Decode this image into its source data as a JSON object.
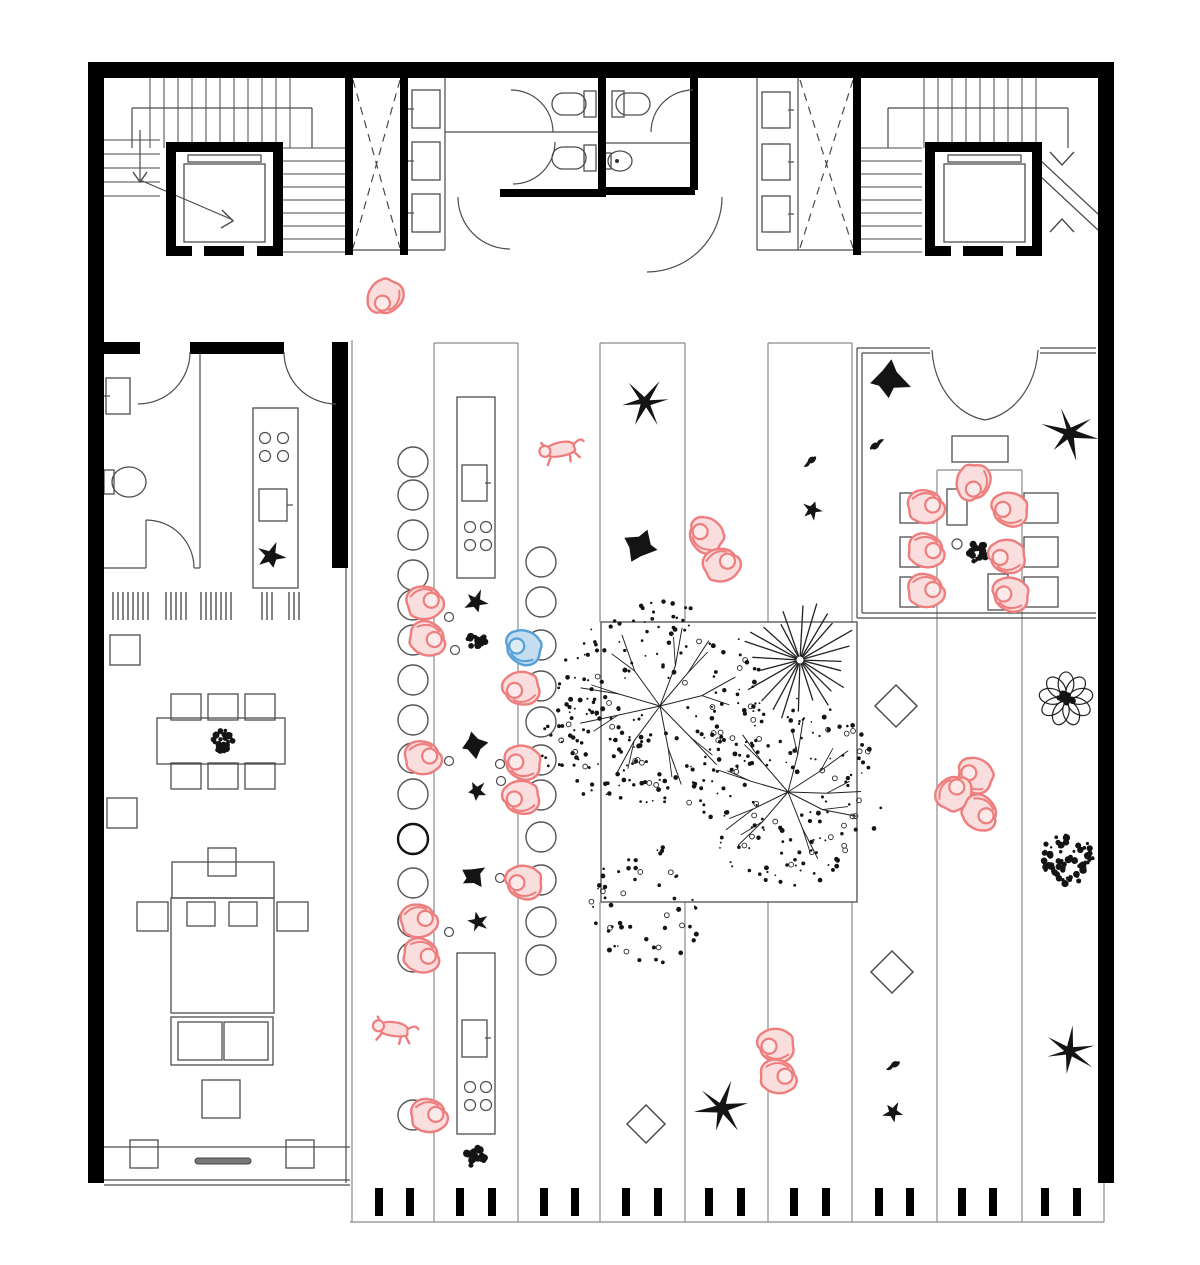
{
  "meta": {
    "width": 1200,
    "height": 1265
  },
  "colors": {
    "wall": "#000000",
    "thin": "#4a4a4a",
    "strip": "#8a8a8a",
    "plant": "#141414",
    "pink": "#ee7d7d",
    "pinkFill": "#fadddd",
    "pinkHead": "#fceaea",
    "blue": "#55a0d6",
    "blueFill": "#c4def0",
    "blueHead": "#ddebf6"
  },
  "wallRects": [
    [
      88,
      62,
      1026,
      16
    ],
    [
      88,
      62,
      16,
      1121
    ],
    [
      1098,
      62,
      16,
      1121
    ],
    [
      345,
      78,
      8,
      177
    ],
    [
      400,
      78,
      8,
      177
    ],
    [
      853,
      78,
      8,
      177
    ],
    [
      598,
      78,
      8,
      119
    ],
    [
      690,
      78,
      8,
      112
    ],
    [
      500,
      189,
      98,
      8
    ],
    [
      603,
      187,
      92,
      8
    ],
    [
      104,
      342,
      36,
      12
    ],
    [
      190,
      342,
      94,
      12
    ],
    [
      332,
      342,
      16,
      226
    ],
    [
      166,
      142,
      117,
      10
    ],
    [
      166,
      142,
      10,
      114
    ],
    [
      273,
      142,
      10,
      114
    ],
    [
      166,
      246,
      26,
      10
    ],
    [
      204,
      246,
      40,
      10
    ],
    [
      257,
      246,
      26,
      10
    ],
    [
      925,
      142,
      117,
      10
    ],
    [
      925,
      142,
      10,
      114
    ],
    [
      1032,
      142,
      10,
      114
    ],
    [
      925,
      246,
      26,
      10
    ],
    [
      963,
      246,
      40,
      10
    ],
    [
      1016,
      246,
      26,
      10
    ]
  ],
  "frames": [
    [
      184,
      164,
      81,
      78
    ],
    [
      188,
      155,
      73,
      7
    ],
    [
      944,
      164,
      81,
      78
    ],
    [
      948,
      155,
      73,
      7
    ],
    [
      412,
      90,
      28,
      38
    ],
    [
      412,
      142,
      28,
      38
    ],
    [
      412,
      194,
      28,
      38
    ],
    [
      762,
      92,
      28,
      36
    ],
    [
      762,
      144,
      28,
      36
    ],
    [
      762,
      196,
      28,
      36
    ],
    [
      584,
      91,
      12,
      26
    ],
    [
      584,
      145,
      12,
      26
    ],
    [
      612,
      91,
      12,
      26
    ],
    [
      603,
      153,
      8,
      16
    ],
    [
      106,
      378,
      24,
      36
    ],
    [
      104,
      470,
      10,
      24
    ],
    [
      253,
      408,
      45,
      180
    ],
    [
      259,
      489,
      28,
      32
    ],
    [
      110,
      635,
      30,
      30
    ],
    [
      107,
      798,
      30,
      30
    ],
    [
      157,
      718,
      128,
      46
    ],
    [
      171,
      694,
      30,
      26
    ],
    [
      208,
      694,
      30,
      26
    ],
    [
      245,
      694,
      30,
      26
    ],
    [
      171,
      763,
      30,
      26
    ],
    [
      208,
      763,
      30,
      26
    ],
    [
      245,
      763,
      30,
      26
    ],
    [
      172,
      862,
      102,
      36
    ],
    [
      208,
      848,
      28,
      28
    ],
    [
      187,
      902,
      28,
      24
    ],
    [
      229,
      902,
      28,
      24
    ],
    [
      171,
      898,
      103,
      115
    ],
    [
      137,
      902,
      31,
      29
    ],
    [
      277,
      902,
      31,
      29
    ],
    [
      171,
      1017,
      102,
      48
    ],
    [
      178,
      1022,
      44,
      38
    ],
    [
      224,
      1022,
      44,
      38
    ],
    [
      202,
      1080,
      38,
      38
    ],
    [
      130,
      1140,
      28,
      28
    ],
    [
      286,
      1140,
      28,
      28
    ],
    [
      457,
      397,
      38,
      181
    ],
    [
      462,
      465,
      25,
      36
    ],
    [
      457,
      953,
      38,
      181
    ],
    [
      462,
      1020,
      25,
      37
    ],
    [
      601,
      622,
      256,
      280
    ],
    [
      900,
      493,
      34,
      30
    ],
    [
      900,
      537,
      34,
      30
    ],
    [
      900,
      577,
      34,
      30
    ],
    [
      1024,
      493,
      34,
      30
    ],
    [
      1024,
      537,
      34,
      30
    ],
    [
      1024,
      577,
      34,
      30
    ],
    [
      952,
      436,
      56,
      26
    ],
    [
      947,
      489,
      20,
      36
    ],
    [
      988,
      574,
      20,
      36
    ]
  ],
  "roundRects": [
    [
      552,
      93,
      34,
      22,
      11
    ],
    [
      552,
      147,
      34,
      22,
      11
    ],
    [
      616,
      93,
      34,
      22,
      11
    ]
  ],
  "slat": [
    195,
    1158,
    56,
    6
  ],
  "thinLines": [
    [
      445,
      78,
      445,
      250
    ],
    [
      757,
      78,
      757,
      250
    ],
    [
      798,
      78,
      798,
      250
    ],
    [
      445,
      132,
      598,
      132
    ],
    [
      603,
      143,
      690,
      143
    ],
    [
      353,
      250,
      445,
      250
    ],
    [
      757,
      250,
      853,
      250
    ],
    [
      200,
      354,
      200,
      568
    ],
    [
      104,
      568,
      146,
      568
    ],
    [
      194,
      568,
      200,
      568
    ],
    [
      146,
      520,
      146,
      568
    ],
    [
      287,
      505,
      293,
      505
    ],
    [
      485,
      483,
      491,
      483
    ],
    [
      485,
      1038,
      491,
      1038
    ],
    [
      408,
      109,
      414,
      109
    ],
    [
      408,
      161,
      414,
      161
    ],
    [
      408,
      213,
      414,
      213
    ],
    [
      788,
      110,
      794,
      110
    ],
    [
      788,
      162,
      794,
      162
    ],
    [
      788,
      214,
      794,
      214
    ],
    [
      104,
      396,
      110,
      396
    ],
    [
      132,
      108,
      132,
      148
    ],
    [
      132,
      108,
      312,
      108
    ],
    [
      312,
      108,
      312,
      148
    ],
    [
      888,
      108,
      888,
      148
    ],
    [
      888,
      108,
      1068,
      108
    ],
    [
      1068,
      108,
      1068,
      148
    ],
    [
      104,
      1147,
      350,
      1147
    ],
    [
      104,
      1180,
      350,
      1180
    ],
    [
      104,
      1185,
      350,
      1185
    ],
    [
      346,
      566,
      346,
      1183
    ],
    [
      140,
      130,
      140,
      180
    ],
    [
      140,
      180,
      233,
      220
    ],
    [
      1040,
      160,
      1098,
      214
    ],
    [
      1040,
      176,
      1098,
      230
    ],
    [
      857,
      348,
      857,
      618
    ],
    [
      862,
      353,
      862,
      613
    ],
    [
      857,
      348,
      930,
      348
    ],
    [
      1040,
      348,
      1096,
      348
    ],
    [
      862,
      353,
      930,
      353
    ],
    [
      1040,
      353,
      1096,
      353
    ],
    [
      857,
      618,
      1096,
      618
    ],
    [
      862,
      613,
      1096,
      613
    ],
    [
      336,
      352,
      336,
      404
    ]
  ],
  "stripLines": [
    [
      352,
      340,
      352,
      1222
    ],
    [
      434,
      343,
      434,
      1222
    ],
    [
      518,
      343,
      518,
      1222
    ],
    [
      434,
      343,
      518,
      343
    ],
    [
      600,
      343,
      600,
      622
    ],
    [
      685,
      343,
      685,
      622
    ],
    [
      600,
      343,
      685,
      343
    ],
    [
      768,
      343,
      768,
      622
    ],
    [
      852,
      343,
      852,
      622
    ],
    [
      768,
      343,
      852,
      343
    ],
    [
      600,
      902,
      600,
      1222
    ],
    [
      685,
      902,
      685,
      1222
    ],
    [
      768,
      902,
      768,
      1222
    ],
    [
      852,
      902,
      852,
      1222
    ],
    [
      937,
      470,
      937,
      1222
    ],
    [
      1022,
      470,
      1022,
      1222
    ],
    [
      937,
      470,
      1022,
      470
    ],
    [
      350,
      1222,
      1104,
      1222
    ],
    [
      1104,
      1181,
      1104,
      1222
    ]
  ],
  "dashLines": [
    [
      353,
      80,
      400,
      248
    ],
    [
      400,
      80,
      353,
      248
    ],
    [
      800,
      80,
      853,
      248
    ],
    [
      853,
      80,
      800,
      248
    ]
  ],
  "arcs": [
    "M511,90 A42 42 0 0 1 553,132",
    "M513,184 A42 42 0 0 0 555,142",
    "M693,90 A42 42 0 0 0 651,132",
    "M458,197 A52 52 0 0 0 510,249",
    "M647,272 A75 75 0 0 0 722,197",
    "M284,352 A52 52 0 0 0 336,404",
    "M190,352 A52 52 0 0 1 138,404",
    "M146,520 A48 48 0 0 1 194,568",
    "M932,350 A62 76 0 0 0 985,420",
    "M1038,350 A62 76 0 0 1 985,420"
  ],
  "polylines": [
    [
      [
        133,
        172
      ],
      [
        140,
        182
      ],
      [
        147,
        172
      ]
    ],
    [
      [
        222,
        210
      ],
      [
        233,
        221
      ],
      [
        221,
        228
      ]
    ],
    [
      [
        1050,
        152
      ],
      [
        1062,
        165
      ],
      [
        1074,
        152
      ]
    ],
    [
      [
        1050,
        232
      ],
      [
        1062,
        219
      ],
      [
        1074,
        232
      ]
    ]
  ],
  "ellipses": [
    [
      620,
      161,
      12,
      10
    ],
    [
      129,
      482,
      17,
      15
    ]
  ],
  "dots": [
    [
      617,
      161,
      2
    ]
  ],
  "smallCircles": [
    [
      265,
      438,
      5.5
    ],
    [
      283,
      438,
      5.5
    ],
    [
      265,
      456,
      5.5
    ],
    [
      283,
      456,
      5.5
    ],
    [
      470,
      527,
      5.5
    ],
    [
      486,
      527,
      5.5
    ],
    [
      470,
      545,
      5.5
    ],
    [
      486,
      545,
      5.5
    ],
    [
      470,
      1087,
      5.5
    ],
    [
      486,
      1087,
      5.5
    ],
    [
      470,
      1105,
      5.5
    ],
    [
      486,
      1105,
      5.5
    ],
    [
      1001,
      503,
      5
    ],
    [
      957,
      544,
      5
    ],
    [
      449,
      617,
      4.5
    ],
    [
      455,
      650,
      4.5
    ],
    [
      449,
      761,
      4.5
    ],
    [
      500,
      764,
      4.5
    ],
    [
      501,
      781,
      4.5
    ],
    [
      500,
      878,
      4.5
    ],
    [
      449,
      932,
      4.5
    ]
  ],
  "mat": {
    "y1": 592,
    "y2": 620,
    "xs": [
      113,
      118,
      123,
      128,
      133,
      138,
      143,
      148,
      166,
      171,
      176,
      181,
      186,
      201,
      206,
      211,
      216,
      221,
      226,
      231,
      262,
      267,
      272,
      289,
      294,
      299
    ]
  },
  "treads": [
    {
      "dir": "v",
      "from": 150,
      "to": 292,
      "step": 14,
      "a": 78,
      "b": 148
    },
    {
      "dir": "h",
      "from": 148,
      "to": 252,
      "step": 13,
      "a": 283,
      "b": 345
    },
    {
      "dir": "h",
      "from": 140,
      "to": 196,
      "step": 14,
      "a": 104,
      "b": 160
    },
    {
      "dir": "v",
      "from": 924,
      "to": 1038,
      "step": 14,
      "a": 78,
      "b": 148
    },
    {
      "dir": "h",
      "from": 148,
      "to": 252,
      "step": 13,
      "a": 860,
      "b": 922
    }
  ],
  "stools": {
    "r": 15,
    "left": {
      "cx": 413,
      "ys": [
        462,
        495,
        535,
        575,
        605,
        640,
        680,
        720,
        758,
        794,
        839,
        883,
        922,
        957,
        1115
      ],
      "bold": [
        839
      ]
    },
    "right": {
      "cx": 541,
      "ys": [
        562,
        602,
        645,
        686,
        722,
        760,
        795,
        837,
        880,
        922,
        960
      ],
      "bold": []
    }
  },
  "ticks": {
    "y": 1188,
    "w": 8,
    "h": 28,
    "xs": [
      375,
      406,
      456,
      488,
      540,
      571,
      622,
      654,
      705,
      737,
      790,
      822,
      875,
      906,
      958,
      989,
      1041,
      1073
    ]
  },
  "diamonds": [
    {
      "x": 896,
      "y": 706,
      "s": 21
    },
    {
      "x": 892,
      "y": 972,
      "s": 21
    },
    {
      "x": 646,
      "y": 1124,
      "s": 19
    }
  ],
  "plants": [
    {
      "t": "palmStar",
      "x": 645,
      "y": 402,
      "s": 25,
      "r": 0,
      "arms": 6
    },
    {
      "t": "palmStar",
      "x": 1070,
      "y": 433,
      "s": 27,
      "r": 20,
      "arms": 6
    },
    {
      "t": "palmStar",
      "x": 722,
      "y": 1108,
      "s": 26,
      "r": -15,
      "arms": 6
    },
    {
      "t": "palmStar",
      "x": 1069,
      "y": 1051,
      "s": 25,
      "r": 40,
      "arms": 6
    },
    {
      "t": "windmill",
      "x": 888,
      "y": 380,
      "s": 21,
      "r": 0
    },
    {
      "t": "windmill",
      "x": 640,
      "y": 546,
      "s": 19,
      "r": 25
    },
    {
      "t": "windmill",
      "x": 474,
      "y": 745,
      "s": 14,
      "r": 0
    },
    {
      "t": "windmill",
      "x": 474,
      "y": 876,
      "s": 14,
      "r": 40
    },
    {
      "t": "bird",
      "x": 877,
      "y": 444,
      "s": 16,
      "r": -15
    },
    {
      "t": "bird",
      "x": 810,
      "y": 462,
      "s": 15,
      "r": 160
    },
    {
      "t": "bird",
      "x": 893,
      "y": 1066,
      "s": 15,
      "r": 170
    },
    {
      "t": "star",
      "x": 812,
      "y": 510,
      "s": 10,
      "r": 0
    },
    {
      "t": "star",
      "x": 893,
      "y": 1112,
      "s": 10,
      "r": 15
    },
    {
      "t": "star",
      "x": 476,
      "y": 602,
      "s": 12,
      "r": 5
    },
    {
      "t": "star",
      "x": 477,
      "y": 791,
      "s": 10,
      "r": 25
    },
    {
      "t": "star",
      "x": 478,
      "y": 922,
      "s": 10,
      "r": 40
    },
    {
      "t": "star",
      "x": 271,
      "y": 556,
      "s": 14,
      "r": 0
    },
    {
      "t": "bush",
      "x": 222,
      "y": 741,
      "s": 11
    },
    {
      "t": "bush",
      "x": 476,
      "y": 641,
      "s": 9
    },
    {
      "t": "bush",
      "x": 476,
      "y": 1157,
      "s": 10
    },
    {
      "t": "bush",
      "x": 1068,
      "y": 858,
      "s": 26
    },
    {
      "t": "bush",
      "x": 978,
      "y": 553,
      "s": 10
    },
    {
      "t": "flower",
      "x": 1066,
      "y": 699,
      "s": 26
    }
  ],
  "trees": [
    {
      "t": "radialPalm",
      "x": 800,
      "y": 660,
      "s": 58,
      "seed": 3
    },
    {
      "t": "canopy",
      "x": 660,
      "y": 706,
      "s": 96,
      "seed": 7
    },
    {
      "t": "canopy",
      "x": 788,
      "y": 792,
      "s": 86,
      "seed": 13
    },
    {
      "t": "spray",
      "x": 596,
      "y": 748,
      "s": 52,
      "seed": 21
    },
    {
      "t": "spray",
      "x": 648,
      "y": 905,
      "s": 55,
      "seed": 33
    }
  ],
  "people": [
    {
      "x": 384,
      "y": 296,
      "rot": 118,
      "c": "pink"
    },
    {
      "x": 425,
      "y": 604,
      "rot": -15,
      "c": "pink"
    },
    {
      "x": 427,
      "y": 640,
      "rot": 12,
      "c": "pink"
    },
    {
      "x": 524,
      "y": 646,
      "rot": 196,
      "c": "blue"
    },
    {
      "x": 521,
      "y": 687,
      "rot": 168,
      "c": "pink"
    },
    {
      "x": 423,
      "y": 759,
      "rot": -8,
      "c": "pink"
    },
    {
      "x": 523,
      "y": 761,
      "rot": 188,
      "c": "pink"
    },
    {
      "x": 521,
      "y": 796,
      "rot": 172,
      "c": "pink"
    },
    {
      "x": 524,
      "y": 881,
      "rot": 182,
      "c": "pink"
    },
    {
      "x": 419,
      "y": 922,
      "rot": -14,
      "c": "pink"
    },
    {
      "x": 421,
      "y": 957,
      "rot": 10,
      "c": "pink"
    },
    {
      "x": 429,
      "y": 1117,
      "rot": -5,
      "c": "pink"
    },
    {
      "x": 707,
      "y": 534,
      "rot": 215,
      "c": "pink"
    },
    {
      "x": 722,
      "y": 566,
      "rot": 335,
      "c": "pink"
    },
    {
      "x": 972,
      "y": 482,
      "rot": 95,
      "c": "pink"
    },
    {
      "x": 926,
      "y": 508,
      "rot": -8,
      "c": "pink"
    },
    {
      "x": 926,
      "y": 552,
      "rot": 5,
      "c": "pink"
    },
    {
      "x": 926,
      "y": 592,
      "rot": -4,
      "c": "pink"
    },
    {
      "x": 1010,
      "y": 508,
      "rot": 185,
      "c": "pink"
    },
    {
      "x": 1007,
      "y": 555,
      "rot": 176,
      "c": "pink"
    },
    {
      "x": 1011,
      "y": 593,
      "rot": 188,
      "c": "pink"
    },
    {
      "x": 976,
      "y": 774,
      "rot": 205,
      "c": "pink"
    },
    {
      "x": 955,
      "y": 794,
      "rot": 300,
      "c": "pink"
    },
    {
      "x": 979,
      "y": 814,
      "rot": 30,
      "c": "pink"
    },
    {
      "x": 776,
      "y": 1044,
      "rot": 178,
      "c": "pink"
    },
    {
      "x": 778,
      "y": 1078,
      "rot": 2,
      "c": "pink"
    }
  ],
  "dogs": [
    {
      "x": 561,
      "y": 450,
      "rot": -12
    },
    {
      "x": 394,
      "y": 1030,
      "rot": 8
    }
  ]
}
